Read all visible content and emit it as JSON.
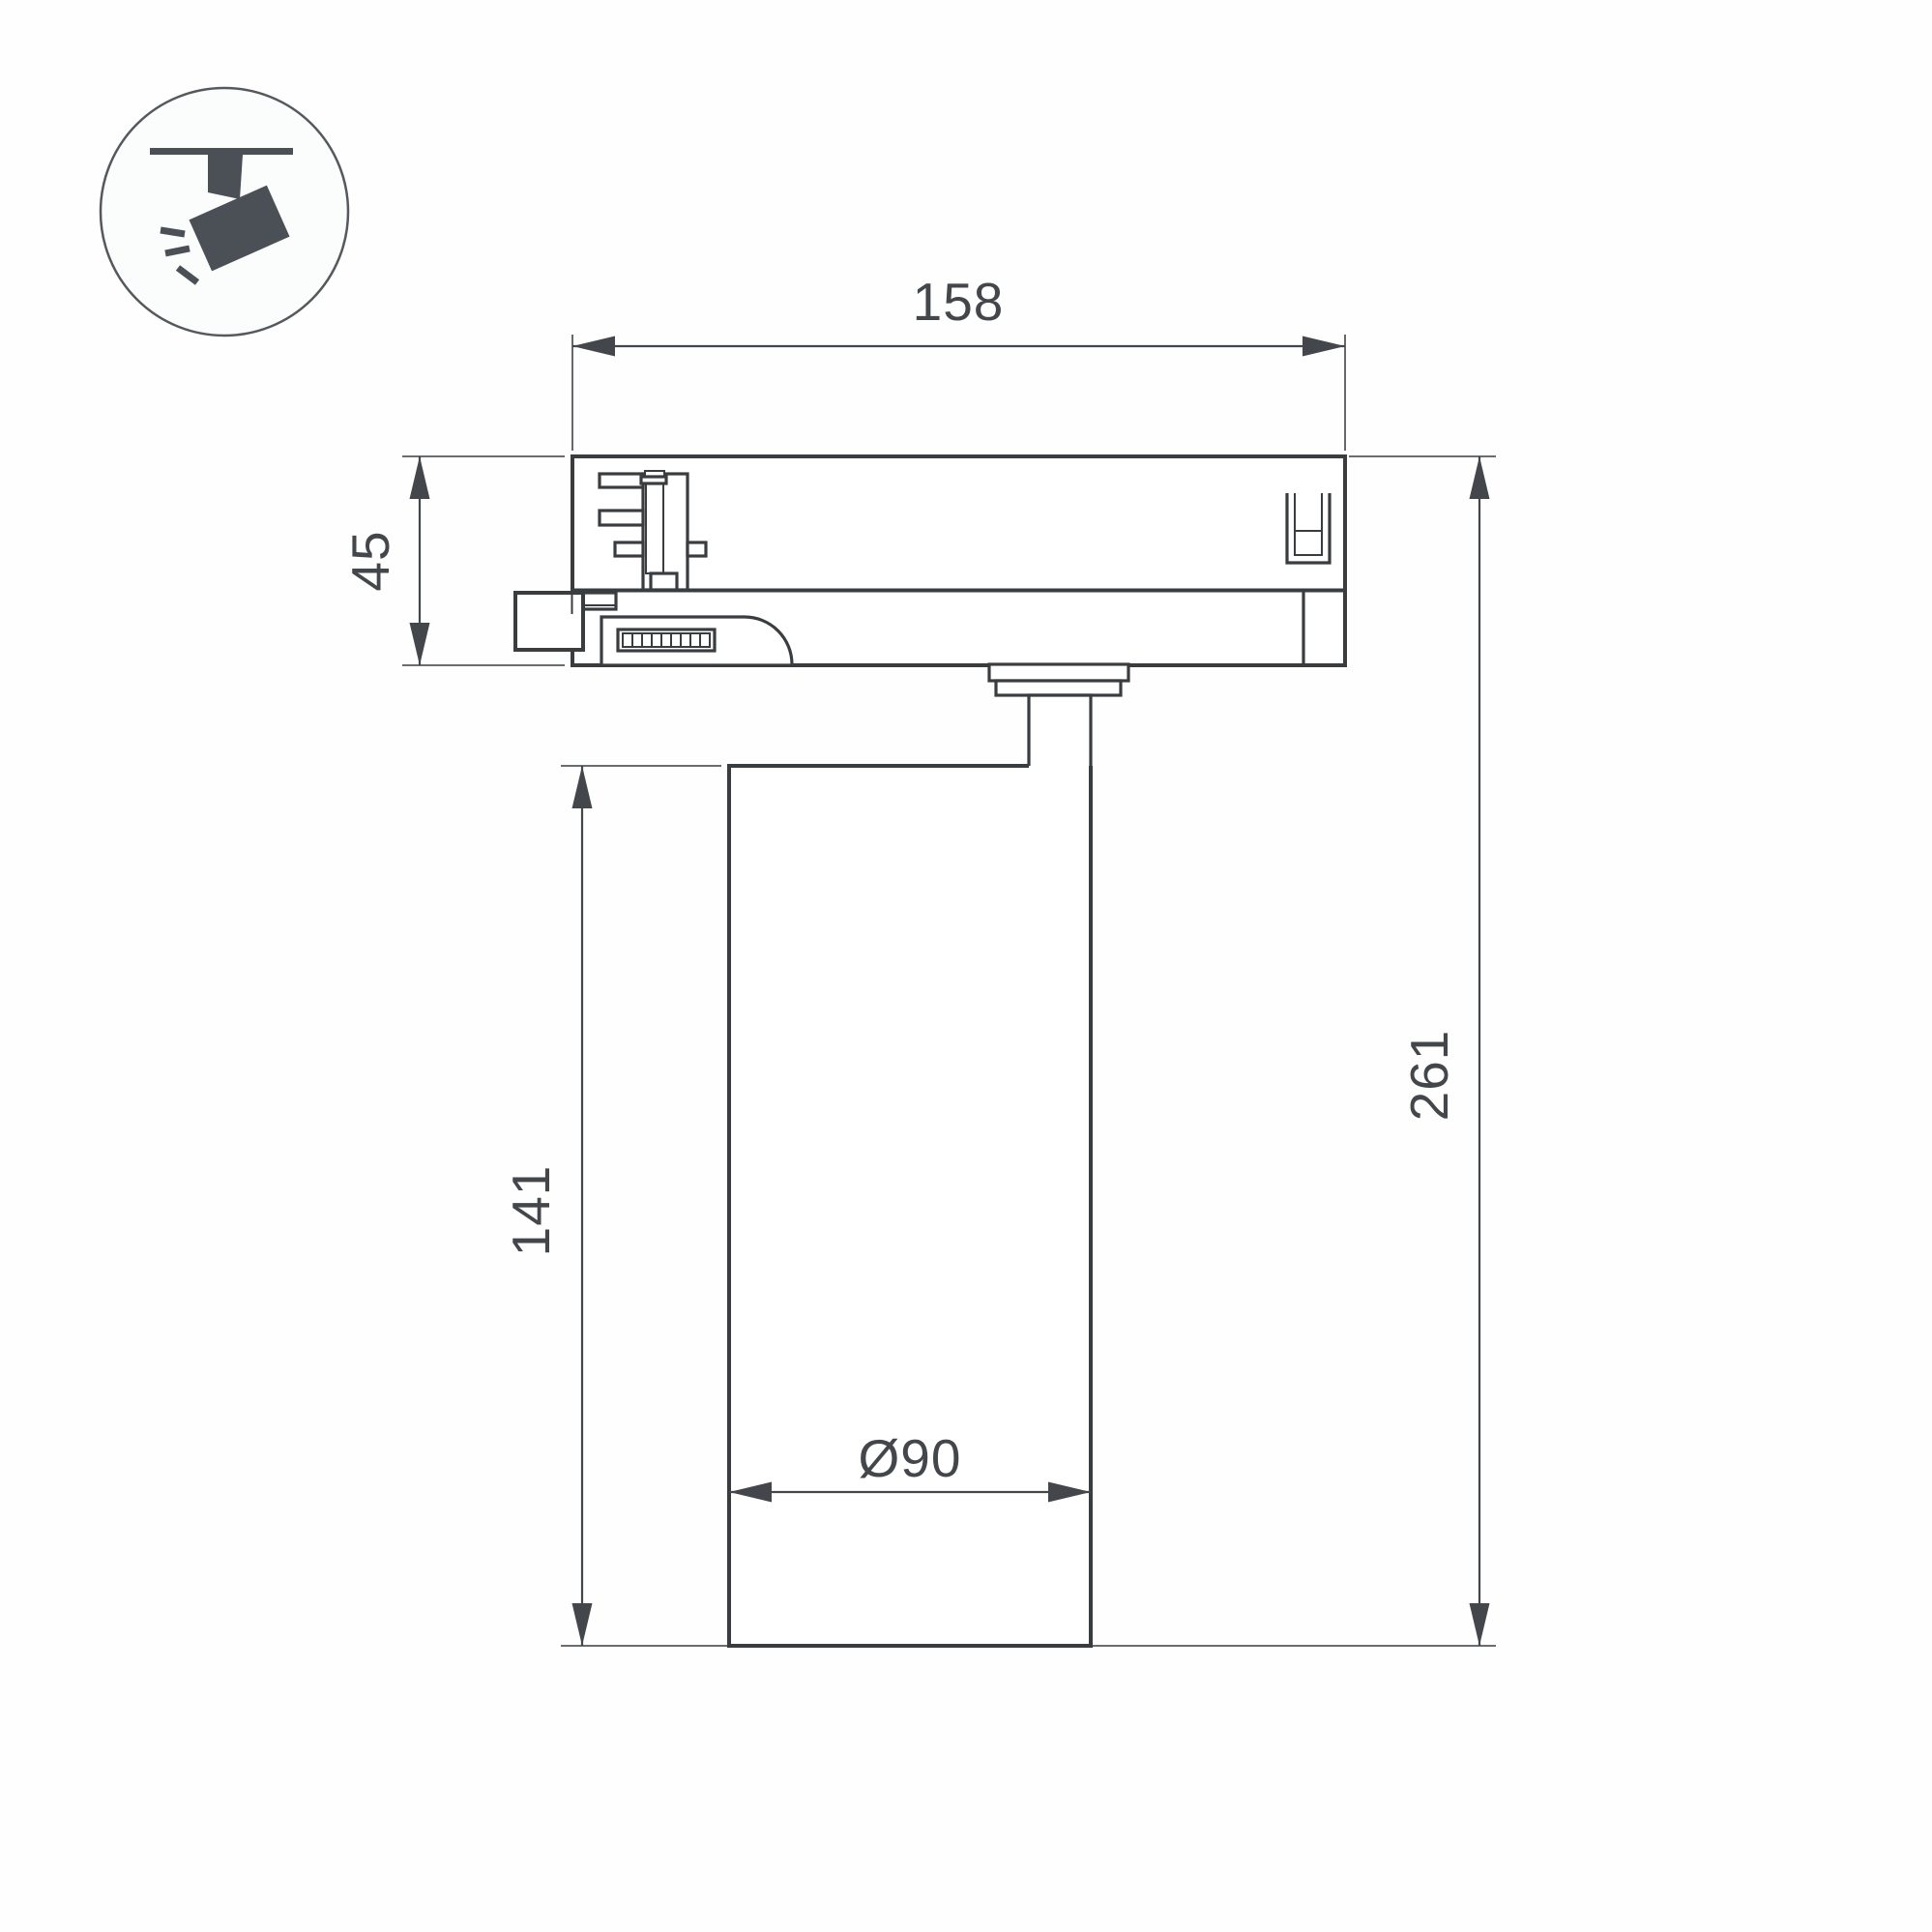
{
  "icon": {
    "name": "track-spotlight-icon"
  },
  "colors": {
    "background": "#fefefe",
    "line": "#393d40",
    "dimension": "#43474b",
    "icon_fill": "#4b5056",
    "icon_circle_stroke": "#55595d"
  },
  "dimensions": {
    "track_adapter_width": "158",
    "track_adapter_height": "45",
    "lamp_body_height": "141",
    "total_height": "261",
    "lamp_body_diameter": "Ø90"
  }
}
